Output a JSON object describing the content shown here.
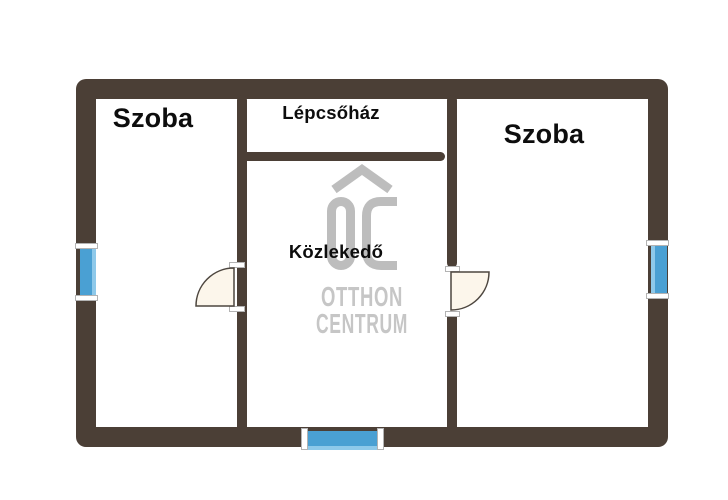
{
  "floorplan": {
    "rooms": [
      {
        "id": "szoba-left",
        "label": "Szoba"
      },
      {
        "id": "lepcsohaz",
        "label": "Lépcsőház"
      },
      {
        "id": "szoba-right",
        "label": "Szoba"
      },
      {
        "id": "kozlekedo",
        "label": "Közlekedő"
      }
    ],
    "features": {
      "windows": 3,
      "doors": 2
    },
    "watermark": {
      "logo": "OC",
      "name_line1": "OTTHON",
      "name_line2": "CENTRUM"
    },
    "colors": {
      "wall": "#4b3f36",
      "window_glass": "#4aa0d3",
      "window_glass_light": "#8ec9ea",
      "door_leaf": "#fcf6eb",
      "watermark_gray": "#c0c0c0",
      "label_text": "#0d0d0d",
      "background": "#ffffff"
    }
  }
}
